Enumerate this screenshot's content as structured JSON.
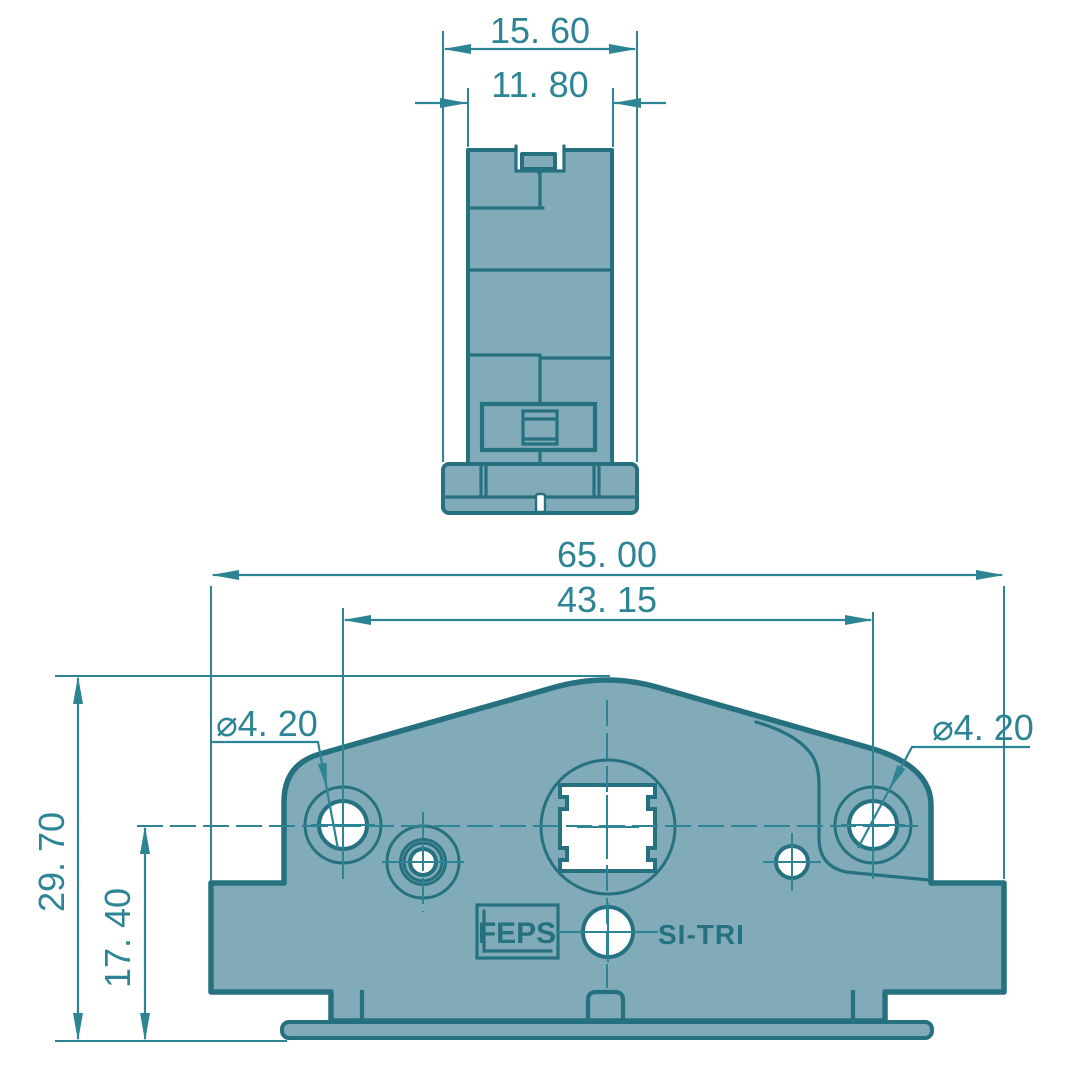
{
  "drawing": {
    "type": "2D engineering drawing, two orthographic views of a DIN-rail mountable component",
    "dims": {
      "top_width_outer": "15. 60",
      "top_width_inner": "11. 80",
      "front_width_overall": "65. 00",
      "front_hole_spacing": "43. 15",
      "front_height_overall": "29. 70",
      "front_hole_center_height": "17. 40",
      "front_hole_left_diameter": "⌀4. 20",
      "front_hole_right_diameter": "⌀4. 20"
    },
    "labels": {
      "logo": "FEPS",
      "product": "SI-TRI"
    },
    "colors": {
      "part-fill": "#81abb8",
      "part-outline": "#26717f",
      "dim": "#2d8494",
      "background": "#ffffff"
    }
  }
}
